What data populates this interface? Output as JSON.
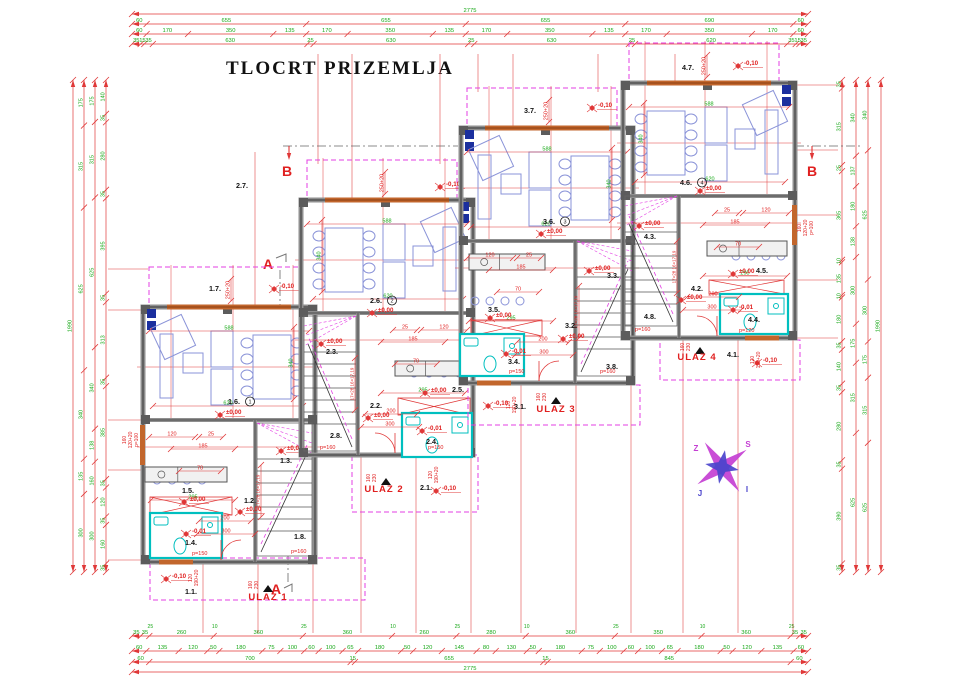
{
  "title": "TLOCRT PRIZEMLJA",
  "colors": {
    "dim_line": "#e03838",
    "dim_text_green": "#18a818",
    "dim_text_red": "#e02020",
    "wall_gray": "#8f8f8f",
    "wall_dark": "#333333",
    "magenta": "#e33fe3",
    "furniture_blue": "#8a93d8",
    "bath_cyan": "#00bfbf",
    "window_orange": "#c2662c",
    "navy": "#1b2f9e",
    "section_red": "#e02020",
    "compass_magenta": "#c43fd3",
    "compass_blue": "#4a43cc",
    "black": "#141414"
  },
  "section": {
    "a": "A",
    "b": "B"
  },
  "compass": {
    "n": "S",
    "w": "Z",
    "e": "I",
    "s": "J"
  },
  "chains": {
    "span_h": [
      132,
      808
    ],
    "span_v": [
      80,
      572
    ],
    "top": [
      {
        "y": 14,
        "vals": [
          "2775"
        ]
      },
      {
        "y": 24,
        "vals": [
          "60",
          "655",
          "655",
          "655",
          "690",
          "60"
        ]
      },
      {
        "y": 34,
        "vals": [
          "60",
          "170",
          "350",
          "135",
          "170",
          "350",
          "135",
          "170",
          "350",
          "135",
          "170",
          "350",
          "170",
          "60"
        ]
      },
      {
        "y": 44,
        "vals": [
          "35",
          "15",
          "35",
          "630",
          "25",
          "630",
          "25",
          "630",
          "25",
          "620",
          "35",
          "15",
          "35"
        ]
      }
    ],
    "bottom": [
      {
        "y": 636,
        "vals": [
          "35",
          "35",
          "260",
          "360",
          "360",
          "260",
          "280",
          "360",
          "350",
          "360",
          "35",
          "35"
        ],
        "subs": [
          "25",
          "10",
          "25",
          "10",
          "25",
          "10",
          "25",
          "10",
          "25"
        ]
      },
      {
        "y": 651,
        "vals": [
          "60",
          "135",
          "120",
          "50",
          "180",
          "75",
          "100",
          "60",
          "100",
          "65",
          "180",
          "50",
          "120",
          "145",
          "80",
          "130",
          "50",
          "180",
          "75",
          "100",
          "60",
          "100",
          "65",
          "180",
          "50",
          "120",
          "135",
          "60"
        ]
      },
      {
        "y": 662,
        "vals": [
          "60",
          "700",
          "15",
          "655",
          "15",
          "845",
          "60"
        ]
      },
      {
        "y": 672,
        "vals": [
          "2775"
        ]
      }
    ],
    "left": [
      {
        "x": 73,
        "vals": [
          "1990"
        ]
      },
      {
        "x": 84,
        "vals": [
          "175",
          "315",
          "625",
          "340",
          "135",
          "300"
        ]
      },
      {
        "x": 95,
        "vals": [
          "175",
          "315",
          "625",
          "340",
          "138",
          "160",
          "300"
        ]
      },
      {
        "x": 106,
        "vals": [
          "140",
          "35",
          "280",
          "35",
          "395",
          "35",
          "313",
          "35",
          "385",
          "35",
          "120",
          "35",
          "160",
          "35"
        ]
      }
    ],
    "right": [
      {
        "x": 842,
        "vals": [
          "35",
          "315",
          "25",
          "365",
          "10",
          "135",
          "10",
          "180",
          "35",
          "140",
          "35",
          "280",
          "35",
          "390",
          "35"
        ]
      },
      {
        "x": 856,
        "vals": [
          "340",
          "137",
          "180",
          "138",
          "300",
          "175",
          "315",
          "625"
        ]
      },
      {
        "x": 868,
        "vals": [
          "340",
          "625",
          "300",
          "175",
          "315",
          "625"
        ]
      },
      {
        "x": 881,
        "vals": [
          "1990"
        ]
      }
    ]
  },
  "unit_dims": [
    {
      "x1": 6,
      "y1": 24,
      "x2": 166,
      "y2": 24,
      "t": "588",
      "c": "g"
    },
    {
      "x1": 10,
      "y1": 99,
      "x2": 160,
      "y2": 99,
      "t": "620",
      "c": "g"
    },
    {
      "x1": 151,
      "y1": 20,
      "x2": 151,
      "y2": 92,
      "t": "340",
      "c": "g",
      "rot": 1
    },
    {
      "x1": 8,
      "y1": 193,
      "x2": 92,
      "y2": 193,
      "t": "295",
      "c": "g"
    },
    {
      "x1": 28,
      "y1": 142,
      "x2": 92,
      "y2": 142,
      "t": "185",
      "c": "r"
    },
    {
      "x1": 6,
      "y1": 130,
      "x2": 52,
      "y2": 130,
      "t": "120",
      "c": "r"
    },
    {
      "x1": 56,
      "y1": 130,
      "x2": 80,
      "y2": 130,
      "t": "25",
      "c": "r"
    },
    {
      "x1": 56,
      "y1": 214,
      "x2": 108,
      "y2": 214,
      "t": "200",
      "c": "r"
    },
    {
      "x1": 54,
      "y1": 227,
      "x2": 112,
      "y2": 227,
      "t": "300",
      "c": "r"
    },
    {
      "x1": 36,
      "y1": 164,
      "x2": 78,
      "y2": 164,
      "t": "70",
      "c": "r"
    },
    {
      "x1": 88,
      "y1": -28,
      "x2": 88,
      "y2": -6,
      "t": "250+20",
      "c": "r",
      "rot": 1
    },
    {
      "x1": 118,
      "y1": 158,
      "x2": 118,
      "y2": 210,
      "t": "17×28 16×17,19",
      "c": "r",
      "rot": 1,
      "sm": 1
    }
  ],
  "window_notes": [
    {
      "lines": [
        "160",
        "120+20",
        "p=100"
      ],
      "x": 126,
      "y": 440
    },
    {
      "lines": [
        "160",
        "120+20",
        "p=100"
      ],
      "x": 801,
      "y": 228
    }
  ],
  "porch_texts": {
    "a": [
      "160",
      "230"
    ],
    "b": [
      "120",
      "190+20"
    ]
  },
  "side_windows": [
    {
      "x": 140,
      "y": 425,
      "w": 5,
      "h": 40
    },
    {
      "x": 792,
      "y": 205,
      "w": 5,
      "h": 40
    }
  ],
  "ext": [
    [
      255,
      152,
      255,
      306
    ],
    [
      318,
      54,
      318,
      164
    ],
    [
      440,
      54,
      440,
      164
    ],
    [
      352,
      54,
      352,
      202
    ],
    [
      513,
      54,
      513,
      130
    ],
    [
      598,
      54,
      598,
      92
    ],
    [
      478,
      54,
      478,
      92
    ],
    [
      675,
      54,
      675,
      85
    ],
    [
      203,
      560,
      203,
      633
    ],
    [
      258,
      560,
      258,
      633
    ],
    [
      313,
      560,
      313,
      633
    ],
    [
      361,
      455,
      361,
      633
    ],
    [
      416,
      455,
      416,
      633
    ],
    [
      471,
      455,
      471,
      633
    ],
    [
      521,
      383,
      521,
      633
    ],
    [
      576,
      383,
      576,
      633
    ],
    [
      631,
      383,
      631,
      633
    ],
    [
      683,
      340,
      683,
      633
    ],
    [
      738,
      340,
      738,
      633
    ],
    [
      793,
      340,
      793,
      633
    ],
    [
      108,
      269,
      148,
      269
    ],
    [
      108,
      310,
      143,
      310
    ],
    [
      108,
      420,
      143,
      420
    ],
    [
      108,
      470,
      143,
      470
    ],
    [
      108,
      560,
      150,
      560
    ],
    [
      795,
      85,
      838,
      85
    ],
    [
      795,
      150,
      838,
      150
    ],
    [
      795,
      215,
      838,
      215
    ],
    [
      795,
      280,
      838,
      280
    ],
    [
      795,
      338,
      838,
      338
    ]
  ],
  "units": [
    {
      "id": "1",
      "mir": false,
      "bx": 143,
      "by": 307,
      "entrance": {
        "label": "ULAZ 1",
        "x": 268,
        "y": 600,
        "tx": 268,
        "ty": 589
      },
      "porch": {
        "x": 150,
        "y": 558,
        "w": 215,
        "h": 42
      },
      "bath": {
        "x": 150,
        "y": 513,
        "w": 72,
        "h": 45
      },
      "stairs": {
        "x": 257,
        "y": 423,
        "w": 55,
        "h": 133
      },
      "kitchenX": {
        "x": 150,
        "y": 497,
        "w": 82,
        "h": 18
      },
      "counter": {
        "x": 145,
        "y": 467,
        "w": 82,
        "h": 15
      },
      "rooms": [
        {
          "t": "1.7.",
          "x": 215,
          "y": 291
        },
        {
          "t": "1.6.",
          "x": 234,
          "y": 404,
          "num": "1"
        },
        {
          "t": "1.5.",
          "x": 188,
          "y": 493
        },
        {
          "t": "1.3.",
          "x": 286,
          "y": 463
        },
        {
          "t": "1.2.",
          "x": 250,
          "y": 503
        },
        {
          "t": "1.4.",
          "x": 191,
          "y": 545
        },
        {
          "t": "1.8.",
          "x": 300,
          "y": 539
        },
        {
          "t": "1.1.",
          "x": 191,
          "y": 594
        }
      ],
      "levels": [
        {
          "t": "-0,10",
          "x": 280,
          "y": 289
        },
        {
          "t": "±0,00",
          "x": 226,
          "y": 415
        },
        {
          "t": "±0,00",
          "x": 190,
          "y": 502
        },
        {
          "t": "±0,00",
          "x": 287,
          "y": 451
        },
        {
          "t": "±0,00",
          "x": 246,
          "y": 512
        },
        {
          "t": "-0,01",
          "x": 192,
          "y": 534
        },
        {
          "t": "-0,10",
          "x": 172,
          "y": 579
        }
      ],
      "ptexts": [
        {
          "t": "p=150",
          "x": 192,
          "y": 555
        },
        {
          "t": "p=160",
          "x": 291,
          "y": 553
        }
      ]
    },
    {
      "id": "2",
      "mir": true,
      "bx": 301,
      "by": 200,
      "entrance": {
        "label": "ULAZ 2",
        "x": 384,
        "y": 492,
        "tx": 386,
        "ty": 482
      },
      "porch": {
        "x": 352,
        "y": 455,
        "w": 126,
        "h": 57
      },
      "bath": {
        "x": 402,
        "y": 413,
        "w": 70,
        "h": 44
      },
      "stairs": {
        "x": 304,
        "y": 316,
        "w": 52,
        "h": 135
      },
      "kitchenX": {
        "x": 398,
        "y": 398,
        "w": 72,
        "h": 17
      },
      "counter": {
        "x": 395,
        "y": 361,
        "w": 76,
        "h": 15
      },
      "rooms": [
        {
          "t": "2.7.",
          "x": 242,
          "y": 188
        },
        {
          "t": "2.6.",
          "x": 376,
          "y": 303,
          "num": "2"
        },
        {
          "t": "2.5.",
          "x": 458,
          "y": 392
        },
        {
          "t": "2.3.",
          "x": 332,
          "y": 354
        },
        {
          "t": "2.2.",
          "x": 376,
          "y": 408
        },
        {
          "t": "2.4.",
          "x": 432,
          "y": 444
        },
        {
          "t": "2.8.",
          "x": 336,
          "y": 438
        },
        {
          "t": "2.1.",
          "x": 426,
          "y": 490
        }
      ],
      "levels": [
        {
          "t": "-0,10",
          "x": 446,
          "y": 187
        },
        {
          "t": "±0,00",
          "x": 378,
          "y": 313
        },
        {
          "t": "±0,00",
          "x": 327,
          "y": 344
        },
        {
          "t": "±0,00",
          "x": 374,
          "y": 418
        },
        {
          "t": "±0,00",
          "x": 431,
          "y": 393
        },
        {
          "t": "-0,01",
          "x": 428,
          "y": 431
        },
        {
          "t": "-0,10",
          "x": 442,
          "y": 491
        }
      ],
      "ptexts": [
        {
          "t": "p=150",
          "x": 428,
          "y": 449
        },
        {
          "t": "p=160",
          "x": 320,
          "y": 449
        }
      ]
    },
    {
      "id": "3",
      "mir": false,
      "bx": 461,
      "by": 128,
      "entrance": {
        "label": "ULAZ 3",
        "x": 556,
        "y": 412,
        "tx": 556,
        "ty": 401
      },
      "porch": {
        "x": 468,
        "y": 385,
        "w": 172,
        "h": 40
      },
      "bath": {
        "x": 460,
        "y": 334,
        "w": 64,
        "h": 42
      },
      "stairs": {
        "x": 577,
        "y": 241,
        "w": 55,
        "h": 135
      },
      "kitchenX": {
        "x": 471,
        "y": 320,
        "w": 71,
        "h": 16
      },
      "counter": {
        "x": 469,
        "y": 254,
        "w": 76,
        "h": 16
      },
      "rooms": [
        {
          "t": "3.7.",
          "x": 530,
          "y": 113
        },
        {
          "t": "3.6.",
          "x": 549,
          "y": 224,
          "num": "3"
        },
        {
          "t": "3.5.",
          "x": 494,
          "y": 312
        },
        {
          "t": "3.3.",
          "x": 613,
          "y": 278
        },
        {
          "t": "3.2.",
          "x": 571,
          "y": 328
        },
        {
          "t": "3.4.",
          "x": 514,
          "y": 364
        },
        {
          "t": "3.8.",
          "x": 612,
          "y": 369
        },
        {
          "t": "3.1.",
          "x": 520,
          "y": 409
        }
      ],
      "levels": [
        {
          "t": "-0,10",
          "x": 598,
          "y": 108
        },
        {
          "t": "±0,00",
          "x": 547,
          "y": 234
        },
        {
          "t": "±0,00",
          "x": 496,
          "y": 318
        },
        {
          "t": "±0,00",
          "x": 595,
          "y": 271
        },
        {
          "t": "±0,00",
          "x": 569,
          "y": 339
        },
        {
          "t": "-0,01",
          "x": 512,
          "y": 354
        },
        {
          "t": "-0,10",
          "x": 494,
          "y": 406
        }
      ],
      "ptexts": [
        {
          "t": "p=150",
          "x": 509,
          "y": 373
        },
        {
          "t": "p=160",
          "x": 600,
          "y": 373
        }
      ]
    },
    {
      "id": "4",
      "mir": true,
      "bx": 623,
      "by": 83,
      "entrance": {
        "label": "ULAZ 4",
        "x": 697,
        "y": 360,
        "tx": 700,
        "ty": 351
      },
      "porch": {
        "x": 660,
        "y": 340,
        "w": 140,
        "h": 40
      },
      "bath": {
        "x": 720,
        "y": 294,
        "w": 68,
        "h": 40
      },
      "stairs": {
        "x": 625,
        "y": 196,
        "w": 52,
        "h": 130
      },
      "kitchenX": {
        "x": 709,
        "y": 280,
        "w": 75,
        "h": 14
      },
      "counter": {
        "x": 707,
        "y": 241,
        "w": 80,
        "h": 15
      },
      "rooms": [
        {
          "t": "4.7.",
          "x": 688,
          "y": 70
        },
        {
          "t": "4.6.",
          "x": 686,
          "y": 185,
          "num": "4"
        },
        {
          "t": "4.5.",
          "x": 762,
          "y": 273
        },
        {
          "t": "4.3.",
          "x": 650,
          "y": 239
        },
        {
          "t": "4.2.",
          "x": 697,
          "y": 291
        },
        {
          "t": "4.4.",
          "x": 754,
          "y": 322
        },
        {
          "t": "4.8.",
          "x": 650,
          "y": 319
        },
        {
          "t": "4.1.",
          "x": 733,
          "y": 357
        }
      ],
      "levels": [
        {
          "t": "-0,10",
          "x": 744,
          "y": 66
        },
        {
          "t": "±0,00",
          "x": 706,
          "y": 191
        },
        {
          "t": "±0,00",
          "x": 645,
          "y": 226
        },
        {
          "t": "±0,00",
          "x": 687,
          "y": 300
        },
        {
          "t": "±0,00",
          "x": 739,
          "y": 274
        },
        {
          "t": "-0,01",
          "x": 739,
          "y": 310
        },
        {
          "t": "-0,10",
          "x": 763,
          "y": 363
        }
      ],
      "ptexts": [
        {
          "t": "p=120",
          "x": 739,
          "y": 332
        },
        {
          "t": "p=160",
          "x": 635,
          "y": 331
        }
      ]
    }
  ]
}
